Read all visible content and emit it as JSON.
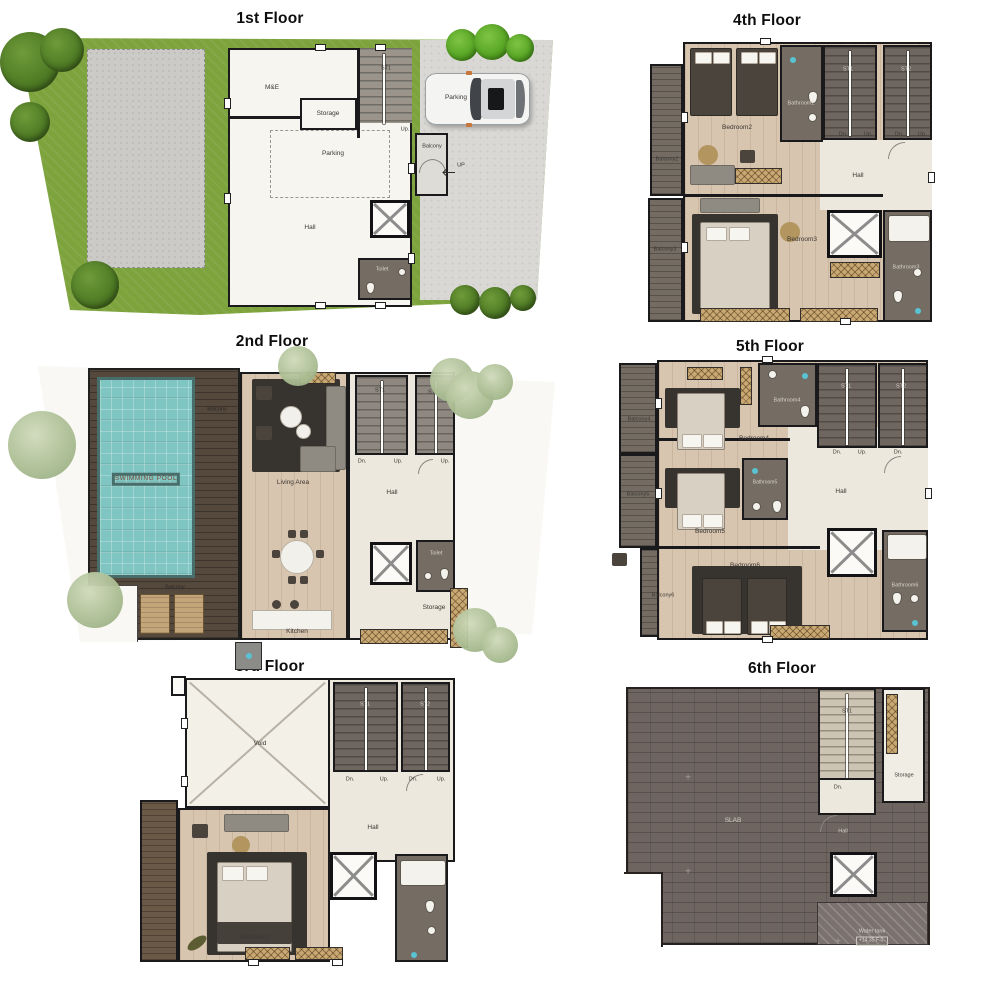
{
  "common": {
    "st1": "ST1",
    "st2": "ST2",
    "dn": "Dn.",
    "up": "Up.",
    "hall": "Hall",
    "storage": "Storage",
    "balcony": "Balcony",
    "toilet": "Toilet",
    "parking": "Parking"
  },
  "floors": {
    "f1": {
      "title": "1st Floor",
      "me": "M&E",
      "up_arrow": "UP"
    },
    "f2": {
      "title": "2nd Floor",
      "pool": "SWIMMING POOL",
      "living": "Living Area",
      "kitchen": "Kitchen"
    },
    "f3": {
      "title": "3rd Floor",
      "void": "Void",
      "bedroom1": "Bedroom1"
    },
    "f4": {
      "title": "4th Floor",
      "balcony2": "Balcony2",
      "balcony3": "Balcony3",
      "bedroom2": "Bedroom2",
      "bedroom3": "Bedroom3",
      "bathroom2": "Bathroom2",
      "bathroom3": "Bathroom3"
    },
    "f5": {
      "title": "5th Floor",
      "balcony4": "Balcony4",
      "balcony5": "Balcony5",
      "balcony6": "Balcony6",
      "bedroom4": "Bedroom4",
      "bedroom5": "Bedroom5",
      "bedroom6": "Bedroom6",
      "bathroom4": "Bathroom4",
      "bathroom5": "Bathroom5",
      "bathroom6": "Bathroom6"
    },
    "f6": {
      "title": "6th Floor",
      "slab": "SLAB",
      "water_tank": "Water tank",
      "level": "+14.35 F-0-"
    }
  },
  "colors": {
    "wall": "#1a1a1c",
    "lawn": "#7da33d",
    "paving": "#d9d8d4",
    "gravel": "#cbcac6",
    "pool": "#7fc6c2",
    "deck": "#55483c",
    "wood_floor": "#d8c5af",
    "hall_cream": "#ece8dd",
    "bathroom_floor": "#756d64",
    "slab": "#6e6561",
    "stair_tan": "#cdc4b3",
    "wardrobe_hatch": "#c9a873",
    "tree_dark": "#4e7a24",
    "tree_bright": "#54a322",
    "tree_sage": "#aabd92",
    "pool_text": "#7c4636"
  }
}
